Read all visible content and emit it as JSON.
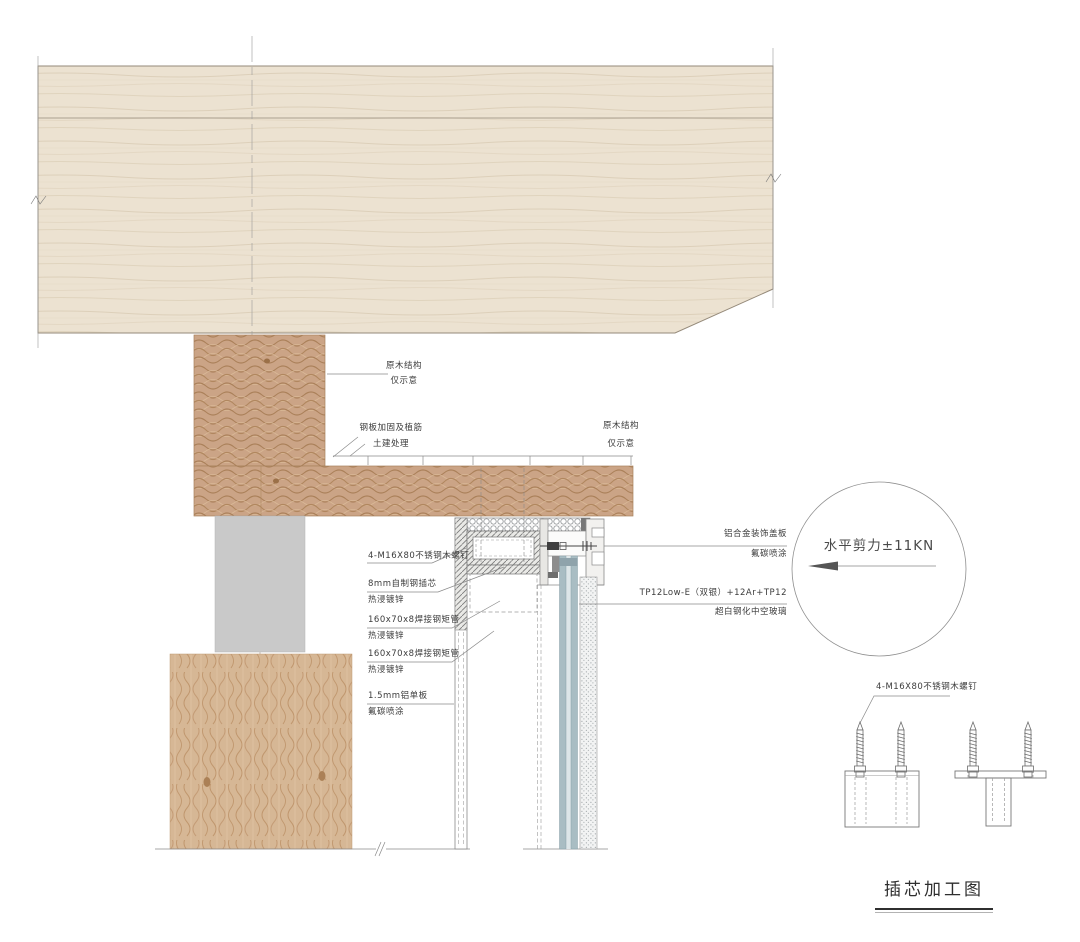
{
  "drawing": {
    "title": "插芯加工图",
    "labels": {
      "timber_top": {
        "l1": "原木结构",
        "l2": "仅示意"
      },
      "steel_plate": {
        "l1": "钢板加固及植筋",
        "l2": "土建处理"
      },
      "timber_right": {
        "l1": "原木结构",
        "l2": "仅示意"
      },
      "screw_left": "4-M16X80不锈钢木螺钉",
      "steel_core": {
        "l1": "8mm自制钢插芯",
        "l2": "热浸镀锌"
      },
      "tube_1": {
        "l1": "160x70x8焊接钢矩管",
        "l2": "热浸镀锌"
      },
      "tube_2": {
        "l1": "160x70x8焊接钢矩管",
        "l2": "热浸镀锌"
      },
      "alu_panel": {
        "l1": "1.5mm铝单板",
        "l2": "氟碳喷涂"
      },
      "cover_plate": {
        "l1": "铝合金装饰盖板",
        "l2": "氟碳喷涂"
      },
      "glazing": {
        "l1": "TP12Low-E（双银）+12Ar+TP12",
        "l2": "超白钢化中空玻璃"
      },
      "shear_force": "水平剪力±11KN",
      "screw_detail": "4-M16X80不锈钢木螺钉"
    },
    "colors": {
      "pale_wood": "#ece2d1",
      "tan_wood": "#cba486",
      "base_wood": "#d6b795",
      "concrete": "#c9c9c9",
      "glass": "#a9bdc3",
      "line": "#8a8a8a"
    }
  }
}
